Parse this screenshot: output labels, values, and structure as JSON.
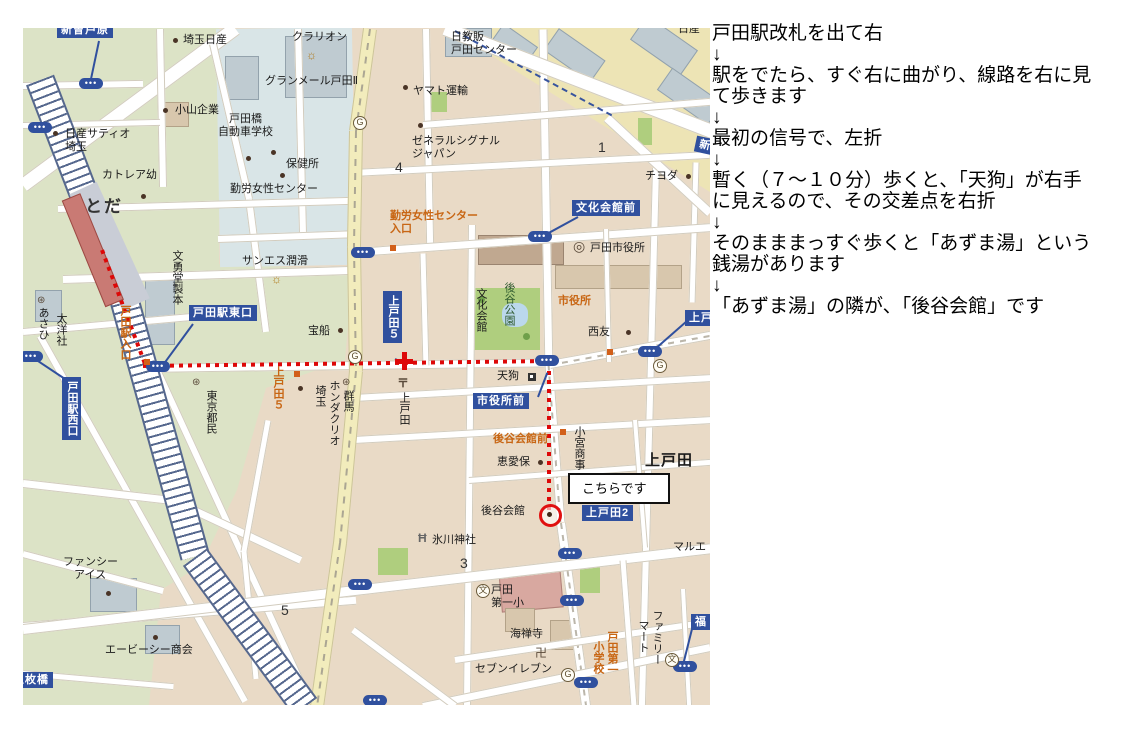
{
  "directions": {
    "arrow": "↓",
    "steps": [
      "戸田駅改札を出て右",
      "駅をでたら、すぐ右に曲がり、線路を右に見\nて歩きます",
      "最初の信号で、左折",
      "暫く（７～１０分）歩くと、「天狗」が右手\nに見えるので、その交差点を右折",
      "そのまままっすぐ歩くと「あずま湯」という\n銭湯があります",
      "「あずま湯」の隣が、「後谷会館」です"
    ]
  },
  "map": {
    "callout": "こちらです",
    "signs": {
      "niizo": "新曽芦原",
      "toda_east": "戸田駅東口",
      "toda_west": "戸田駅西口",
      "kamitoda5": "上戸田５",
      "bunka_mae": "文化会館前",
      "shiyakusho_mae": "市役所前",
      "kamitoda2": "上戸田2",
      "kamitoda_cut": "上戸",
      "fuku_cut": "福",
      "maibashi": "五枚橋",
      "shin_cut": "新"
    },
    "icons": {
      "bus_dots": "•••",
      "gas": "G",
      "school": "文",
      "postal_mark": "〒",
      "city_office_mark": "◎",
      "company_mark": "⊛",
      "factory_mark": "☼",
      "torii_mark": "Ħ",
      "manji_mark": "卍"
    },
    "labels": {
      "saitama_nissan": "埼玉日産",
      "clarion": "クラリオン",
      "grandmaire": "グランメール戸田Ⅱ",
      "nikkyohan": "日教販\n戸田センター",
      "nissan_cut": "日産",
      "koyama": "小山企業",
      "nissan_satio": "日産サティオ\n埼玉",
      "toda_bashi": "戸田橋\n自動車学校",
      "yamato": "ヤマト運輸",
      "hokensho": "保健所",
      "cattleya": "カトレア幼",
      "kinro_center": "勤労女性センター",
      "general_signal": "ゼネラルシグナル\nジャパン",
      "block1": "1",
      "block4": "4",
      "block3": "3",
      "block5": "5",
      "chiyoda": "チヨダ",
      "toda_station": "とだ",
      "bunyudo": "文勇堂製本",
      "asahi": "あさひ",
      "taiyosha": "太洋社",
      "tokyo_tomin": "東京都民",
      "sanesu": "サンエス潤滑",
      "takarabune": "宝船",
      "saitama_v": "埼玉",
      "honda_clio": "ホンダクリオ",
      "gunma": "群馬",
      "kamitoda_post": "上戸田",
      "kamitoda_big": "上戸田",
      "seiyu": "西友",
      "tengu": "天狗",
      "keiaiho": "恵愛保",
      "komiya": "小宮商事",
      "goyakaikan": "後谷会館",
      "hikawa": "氷川神社",
      "fancy_ice": "ファンシー\n　アイス",
      "abc_shokai": "エービーシー商会",
      "toda_daiichi": "戸田\n第一小",
      "kaizenji": "海禅寺",
      "seven": "セブンイレブン",
      "marue": "マルエ",
      "bunka_kaikan": "文化会館",
      "goya_park": "後谷公園",
      "toda_cityhall": "戸田市役所",
      "familymart_r": "ファミリー",
      "familymart_l": "マート",
      "toda_school_r": "戸田第一",
      "toda_school_l": "小学校",
      "kinro_iriguchi": "勤労女性センター\n入口",
      "toda_eki_iriguchi": "戸田駅入口",
      "kamitoda5_orange": "上戸田５",
      "goyakaikan_mae": "後谷会館前",
      "shiyakusho_orange": "市役所"
    },
    "colors": {
      "route_red": "#DD0808",
      "sign_blue": "#30509E",
      "intersection_orange": "#C86614"
    }
  }
}
